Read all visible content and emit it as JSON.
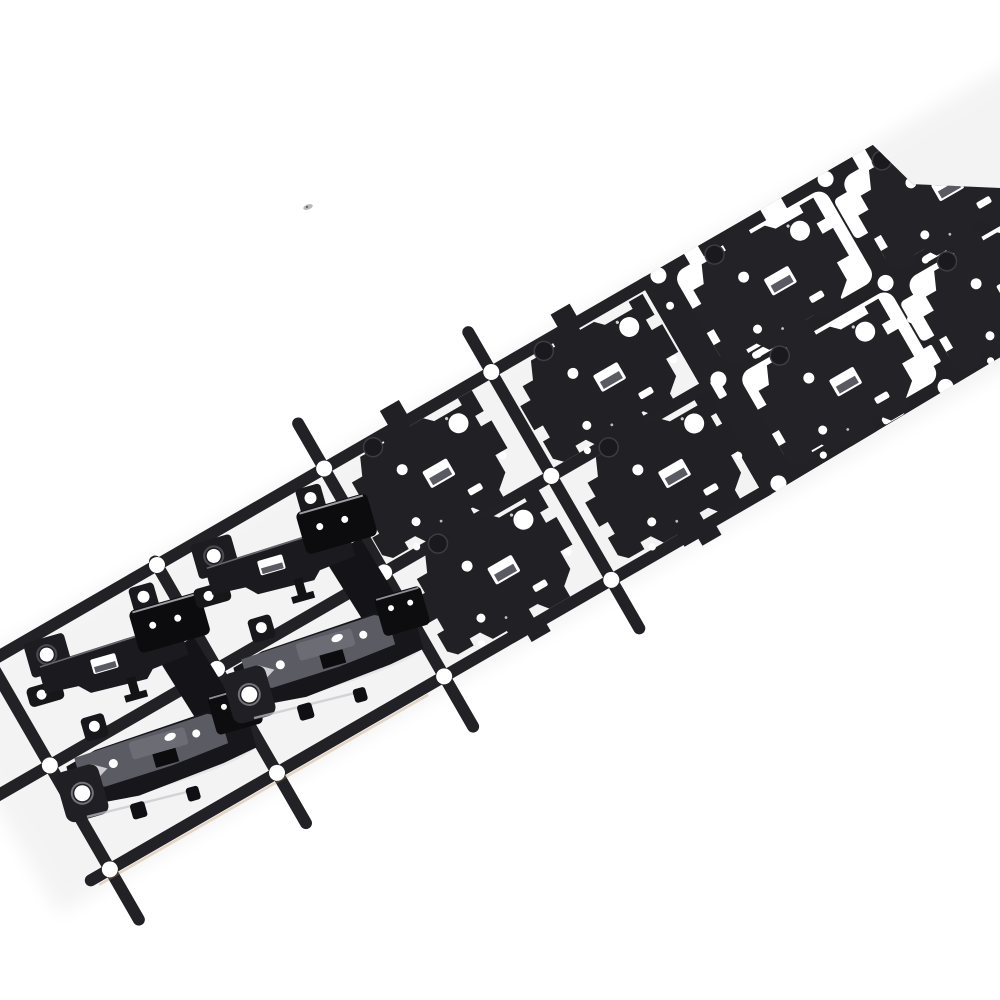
{
  "scene": {
    "type": "product-photograph",
    "subject": "progressive die stamping strip with black metal laptop-hinge brackets",
    "description": "Black stamped metal carrier strip running diagonally from lower-left to upper-right on a white background. Right end: solid blanked sheet with white punched cutouts. Middle: flat hinge blanks held in white windows by tabs. Lower-left: formed three-dimensional hinge bracket assemblies lifted from open carrier frames with round pilot holes at rail junctions.",
    "background_color": "#ffffff"
  },
  "palette": {
    "metal": "#222226",
    "metal_part": "#212125",
    "metal_deep": "#0c0c0e",
    "metal_dark": "#17171b",
    "face_gray": "#5b5b64",
    "face_light": "#6c6c75",
    "ledge_gray": "#5a5a62",
    "highlight": "#c6c6cc",
    "ring_gray": "#72727a",
    "fringe_warm": "#b9854e",
    "hole_white": "#ffffff",
    "speck_gray": "#8a8a8e"
  },
  "strip": {
    "rotation_deg": -30,
    "origin": {
      "x": 157,
      "y": 565
    },
    "along_pitch_px": 193,
    "across_pitch_px": 120,
    "rail_width_px": 12,
    "pilot_hole_r_px": 8,
    "rows": 2,
    "visible_columns": 7,
    "direction": "lower-left to upper-right"
  },
  "stations": [
    {
      "order": 1,
      "zone": "right",
      "label": "piercing and partial blanking in solid sheet"
    },
    {
      "order": 2,
      "zone": "middle-right",
      "label": "window cutting around blanks"
    },
    {
      "order": 3,
      "zone": "middle-left",
      "label": "flat blanks held by carrier tabs"
    },
    {
      "order": 4,
      "zone": "left",
      "label": "formed and lifted hinge assemblies"
    }
  ],
  "object_counts": {
    "formed_hinge_assemblies": 2,
    "flat_blank_parts": 4,
    "embedded_blank_parts": 4,
    "pilot_holes_visible": 18,
    "empty_frame_cells": 2
  },
  "rails": {
    "along": [
      {
        "v": 0,
        "u1": -250,
        "u2": 566
      },
      {
        "v": 120,
        "u1": -285,
        "u2": 566
      },
      {
        "v": 240,
        "u1": -215,
        "u2": 566
      }
    ],
    "across": [
      {
        "u": -193,
        "v1": -4,
        "v2": 298
      },
      {
        "u": 0,
        "v1": -4,
        "v2": 298
      },
      {
        "u": 193,
        "v1": -52,
        "v2": 298
      },
      {
        "u": 386,
        "v1": -46,
        "v2": 296
      }
    ],
    "fringe": {
      "v": 248,
      "u1": -210,
      "u2": 170
    }
  },
  "pilot_holes": {
    "left_zone": [
      [
        -193,
        0
      ],
      [
        -193,
        120
      ],
      [
        -193,
        240
      ],
      [
        0,
        0
      ],
      [
        0,
        120
      ],
      [
        0,
        240
      ],
      [
        193,
        0
      ],
      [
        193,
        120
      ],
      [
        193,
        240
      ],
      [
        386,
        0
      ],
      [
        386,
        120
      ],
      [
        386,
        240
      ]
    ],
    "in_sheet": [
      [
        579,
        0
      ],
      [
        579,
        120
      ],
      [
        579,
        240
      ],
      [
        772,
        0
      ],
      [
        772,
        120
      ],
      [
        772,
        240
      ]
    ]
  },
  "sheet": {
    "outline": [
      [
        560,
        -6
      ],
      [
        830,
        -6
      ],
      [
        845,
        48
      ],
      [
        920,
        96
      ],
      [
        1080,
        144
      ],
      [
        1080,
        238
      ],
      [
        560,
        246
      ]
    ],
    "windows": [
      {
        "x": 592,
        "y": 6,
        "w": 174,
        "h": 106
      },
      {
        "x": 598,
        "y": 126,
        "w": 174,
        "h": 104
      },
      {
        "x": 784,
        "y": 8,
        "w": 174,
        "h": 102
      },
      {
        "x": 790,
        "y": 128,
        "w": 174,
        "h": 98
      }
    ],
    "notches": [
      {
        "x": 612,
        "y": -10,
        "w": 16,
        "h": 24
      },
      {
        "x": 700,
        "y": -9,
        "w": 24,
        "h": 20
      },
      {
        "x": 806,
        "y": -11,
        "w": 15,
        "h": 28
      }
    ],
    "cutouts": [
      {
        "t": "L",
        "x": 768,
        "y": 22
      },
      {
        "t": "L",
        "x": 774,
        "y": 144
      },
      {
        "t": "L",
        "x": 962,
        "y": 26
      },
      {
        "t": "L",
        "x": 968,
        "y": 148
      },
      {
        "t": "L",
        "x": 1040,
        "y": 206
      },
      {
        "t": "r",
        "x": 767,
        "y": 196,
        "w": 14,
        "h": 20
      },
      {
        "t": "r",
        "x": 1000,
        "y": 58,
        "w": 30,
        "h": 13
      },
      {
        "t": "r",
        "x": 1014,
        "y": 188,
        "w": 28,
        "h": 12
      },
      {
        "t": "r",
        "x": 570,
        "y": 118,
        "w": 9,
        "h": 20
      },
      {
        "t": "c",
        "x": 776,
        "y": 164,
        "r": 4
      },
      {
        "t": "c",
        "x": 1034,
        "y": 124,
        "r": 5
      },
      {
        "t": "c",
        "x": 988,
        "y": 18,
        "r": 4
      },
      {
        "t": "c",
        "x": 574,
        "y": 32,
        "r": 4
      },
      {
        "t": "s",
        "x": 620,
        "y": 114,
        "w": 26,
        "h": 7
      },
      {
        "t": "s",
        "x": 816,
        "y": 116,
        "w": 26,
        "h": 7
      },
      {
        "t": "s",
        "x": 1044,
        "y": 162,
        "w": 24,
        "h": 8
      },
      {
        "t": "s",
        "x": 700,
        "y": 235,
        "w": 24,
        "h": 8
      },
      {
        "t": "s",
        "x": 902,
        "y": 236,
        "w": 24,
        "h": 8
      }
    ],
    "dimples": [
      [
        650,
        40
      ],
      [
        656,
        162
      ],
      [
        842,
        44
      ],
      [
        848,
        166
      ],
      [
        1005,
        100
      ]
    ]
  },
  "flat_parts": [
    [
      206,
      -8
    ],
    [
      214,
      108
    ],
    [
      402,
      -6
    ],
    [
      410,
      110
    ]
  ],
  "embedded_parts": [
    [
      598,
      -4
    ],
    [
      604,
      116
    ],
    [
      790,
      -2
    ],
    [
      796,
      118
    ]
  ],
  "formed_assemblies": [
    {
      "x": -184,
      "y": 14,
      "rot": 14
    },
    {
      "x": 10,
      "y": 12,
      "rot": 14
    }
  ],
  "speck": {
    "x": 308,
    "y": 207,
    "rx": 5,
    "ry": 2.5,
    "rot": -20
  }
}
